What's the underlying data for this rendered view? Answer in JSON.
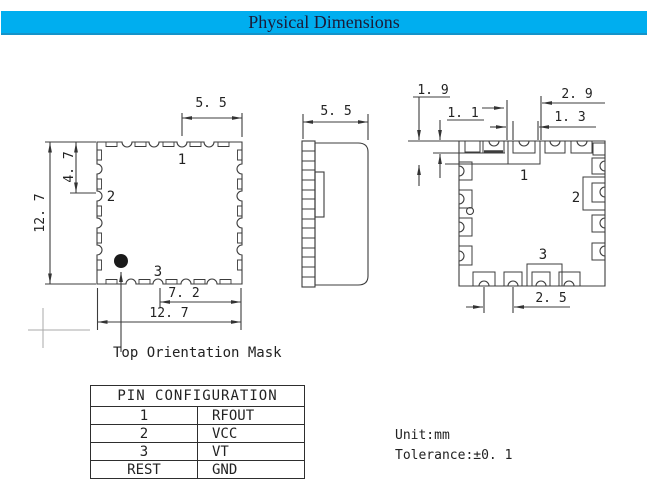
{
  "title_bar": {
    "title": "Physical Dimensions",
    "bg_color": "#00AEEF"
  },
  "top_view": {
    "dim_top": "5. 5",
    "dim_height": "12. 7",
    "dim_pin2_offset": "4. 7",
    "dim_bottom_inner": "7. 2",
    "dim_width": "12. 7",
    "pin1": "1",
    "pin2": "2",
    "pin3": "3",
    "orientation_note": "Top Orientation Mask"
  },
  "side_view": {
    "dim_width": "5. 5"
  },
  "bottom_view": {
    "dim_pad_long": "1. 9",
    "dim_pad_short": "1. 1",
    "dim_pin1_outer": "2. 9",
    "dim_pin1_inner": "1. 3",
    "dim_pad_pitch": "2. 5",
    "pin1": "1",
    "pin2": "2",
    "pin3": "3"
  },
  "pin_table": {
    "header": "PIN CONFIGURATION",
    "rows": [
      {
        "pin": "1",
        "signal": "RFOUT"
      },
      {
        "pin": "2",
        "signal": "VCC"
      },
      {
        "pin": "3",
        "signal": "VT"
      },
      {
        "pin": "REST",
        "signal": "GND"
      }
    ]
  },
  "notes": {
    "unit": "Unit:mm",
    "tolerance": "Tolerance:±0. 1"
  }
}
